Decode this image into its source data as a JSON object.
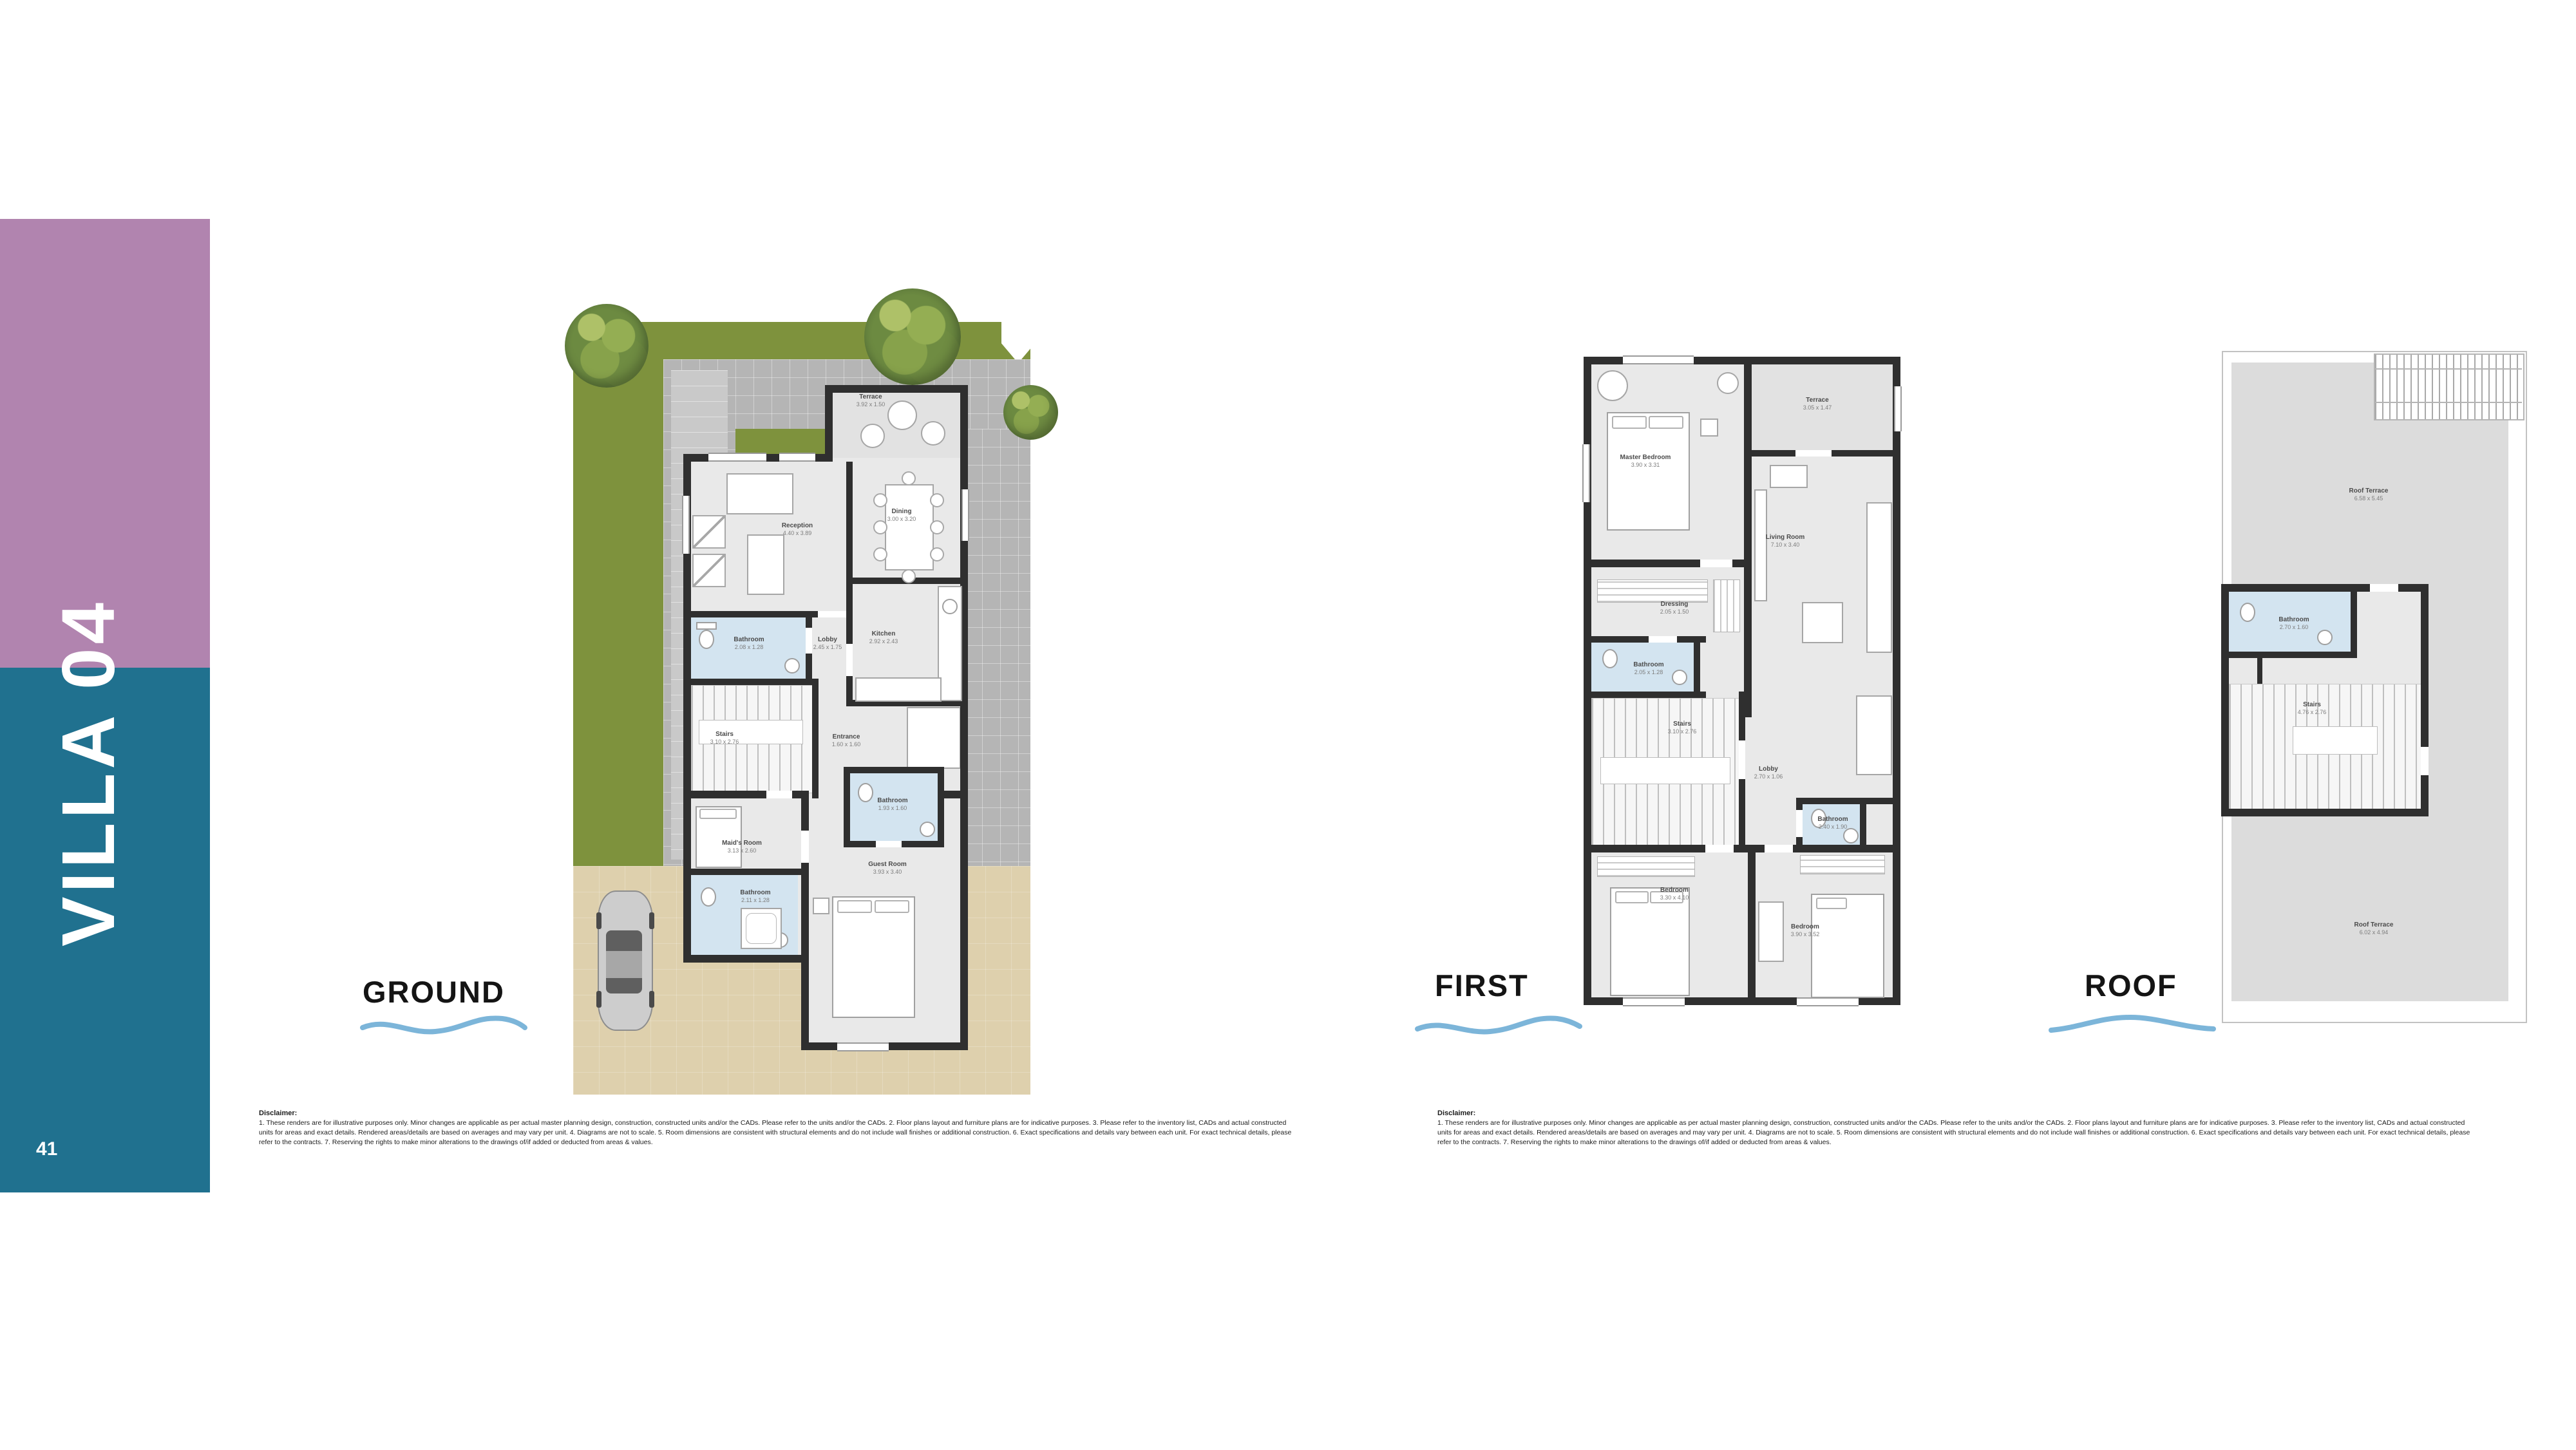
{
  "sidebar": {
    "title": "VILLA 04",
    "page_number": "41"
  },
  "plans": {
    "ground": {
      "title": "GROUND",
      "rooms": [
        {
          "name": "Terrace",
          "dims": "3.92 x 1.50"
        },
        {
          "name": "Reception",
          "dims": "4.40 x 3.89"
        },
        {
          "name": "Dining",
          "dims": "3.00 x 3.20"
        },
        {
          "name": "Kitchen",
          "dims": "2.92 x 2.43"
        },
        {
          "name": "Bathroom",
          "dims": "2.08 x 1.28"
        },
        {
          "name": "Lobby",
          "dims": "2.45 x 1.75"
        },
        {
          "name": "Stairs",
          "dims": "3.10 x 2.76"
        },
        {
          "name": "Entrance",
          "dims": "1.60 x 1.60"
        },
        {
          "name": "Bathroom",
          "dims": "1.93 x 1.60"
        },
        {
          "name": "Maid's Room",
          "dims": "3.13 x 2.60"
        },
        {
          "name": "Bathroom",
          "dims": "2.11 x 1.28"
        },
        {
          "name": "Guest Room",
          "dims": "3.93 x 3.40"
        }
      ]
    },
    "first": {
      "title": "FIRST",
      "rooms": [
        {
          "name": "Master Bedroom",
          "dims": "3.90 x 3.31"
        },
        {
          "name": "Terrace",
          "dims": "3.05 x 1.47"
        },
        {
          "name": "Living Room",
          "dims": "7.10 x 3.40"
        },
        {
          "name": "Dressing",
          "dims": "2.05 x 1.50"
        },
        {
          "name": "Bathroom",
          "dims": "2.05 x 1.28"
        },
        {
          "name": "Stairs",
          "dims": "3.10 x 2.76"
        },
        {
          "name": "Lobby",
          "dims": "2.70 x 1.06"
        },
        {
          "name": "Bathroom",
          "dims": "2.40 x 1.90"
        },
        {
          "name": "Bedroom",
          "dims": "3.30 x 4.10"
        },
        {
          "name": "Bedroom",
          "dims": "3.90 x 3.52"
        }
      ]
    },
    "roof": {
      "title": "ROOF",
      "rooms": [
        {
          "name": "Roof Terrace",
          "dims": "6.58 x 5.45"
        },
        {
          "name": "Bathroom",
          "dims": "2.70 x 1.60"
        },
        {
          "name": "Stairs",
          "dims": "4.76 x 2.76"
        },
        {
          "name": "Roof Terrace",
          "dims": "6.02 x 4.94"
        }
      ]
    }
  },
  "disclaimer": {
    "heading": "Disclaimer:",
    "body": "1. These renders are for illustrative purposes only. Minor changes are applicable as per actual master planning design, construction, constructed units and/or the CADs. Please refer to the units and/or the CADs. 2. Floor plans layout and furniture plans are for indicative purposes. 3. Please refer to the inventory list, CADs and actual constructed units for areas and exact details. Rendered areas/details are based on averages and may vary per unit. 4. Diagrams are not to scale. 5. Room dimensions are consistent with structural elements and do not include wall finishes or additional construction. 6. Exact specifications and details vary between each unit. For exact technical details, please refer to the contracts. 7. Reserving the rights to make minor alterations to the drawings of/if added or deducted from areas & values."
  },
  "colors": {
    "purple": "#b184af",
    "teal": "#20718f",
    "wave_blue": "#7cb5d9",
    "grass": "#7e923d",
    "pavement": "#b5b5b5",
    "driveway": "#ded0ad",
    "wall": "#2f2f2f",
    "floor": "#e9e9e9",
    "bath": "#d3e4f0",
    "roofterrace": "#dcdcdc"
  }
}
